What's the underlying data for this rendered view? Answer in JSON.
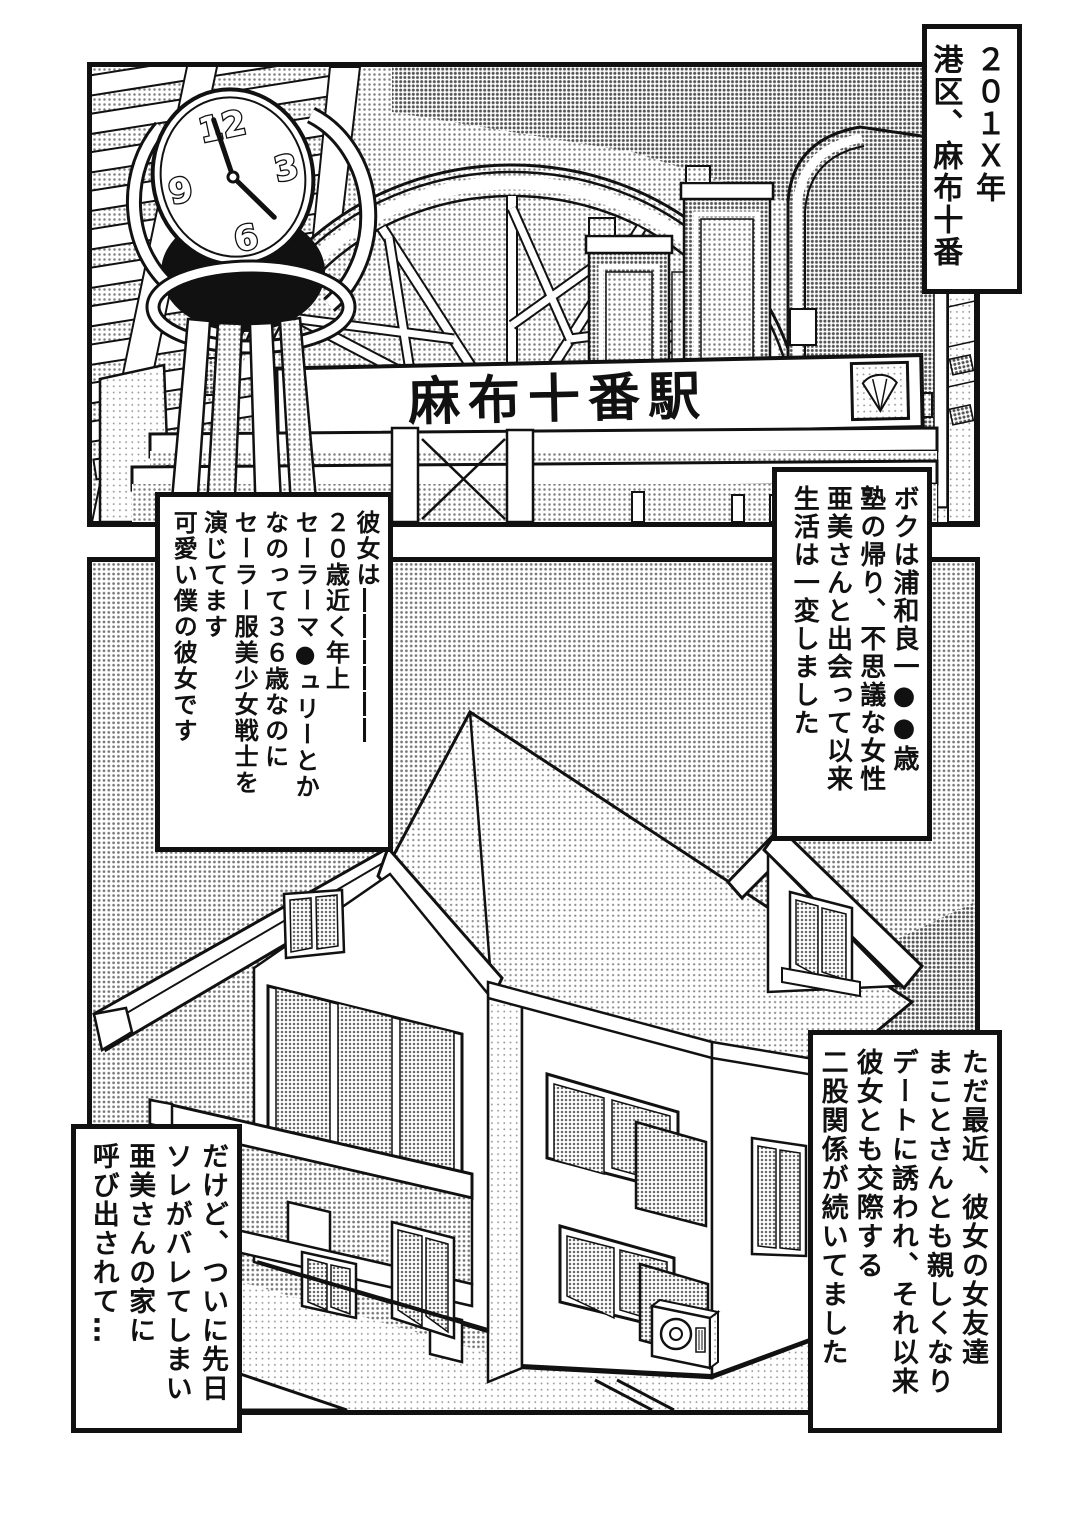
{
  "page": {
    "type": "manga page",
    "bg": "#ffffff",
    "ink": "#111111",
    "halftone": "#808080"
  },
  "top_panel": {
    "scene": "azabu-juban station street with clock tower and skyscrapers",
    "station_sign": "麻布十番駅",
    "clock": {
      "twelve": "12",
      "three": "3",
      "six": "6",
      "nine": "9"
    },
    "caption_year": {
      "lines": [
        "２０１Ｘ年",
        "港区、麻布十番"
      ]
    },
    "caption_narrator": {
      "lines": [
        "ボクは浦和良一●●歳",
        "塾の帰り、不思議な女性",
        "亜美さんと出会って以来",
        "生活は一変しました"
      ]
    }
  },
  "bottom_panel": {
    "scene": "two-story house exterior with balcony",
    "caption_girlfriend": {
      "lines": [
        "彼女は――――――",
        "２０歳近く年上",
        "セーラーマ●ュリーとか",
        "なのって３６歳なのに",
        "セーラー服美少女戦士を",
        "演じてます",
        "可愛い僕の彼女です"
      ]
    },
    "caption_affair": {
      "lines": [
        "ただ最近、彼女の女友達",
        "まことさんとも親しくなり",
        "デートに誘われ、それ以来",
        "彼女とも交際する",
        "二股関係が続いてました"
      ]
    },
    "caption_summoned": {
      "lines": [
        "だけど、ついに先日",
        "ソレがバレてしまい",
        "亜美さんの家に",
        "呼び出されて…"
      ]
    }
  }
}
